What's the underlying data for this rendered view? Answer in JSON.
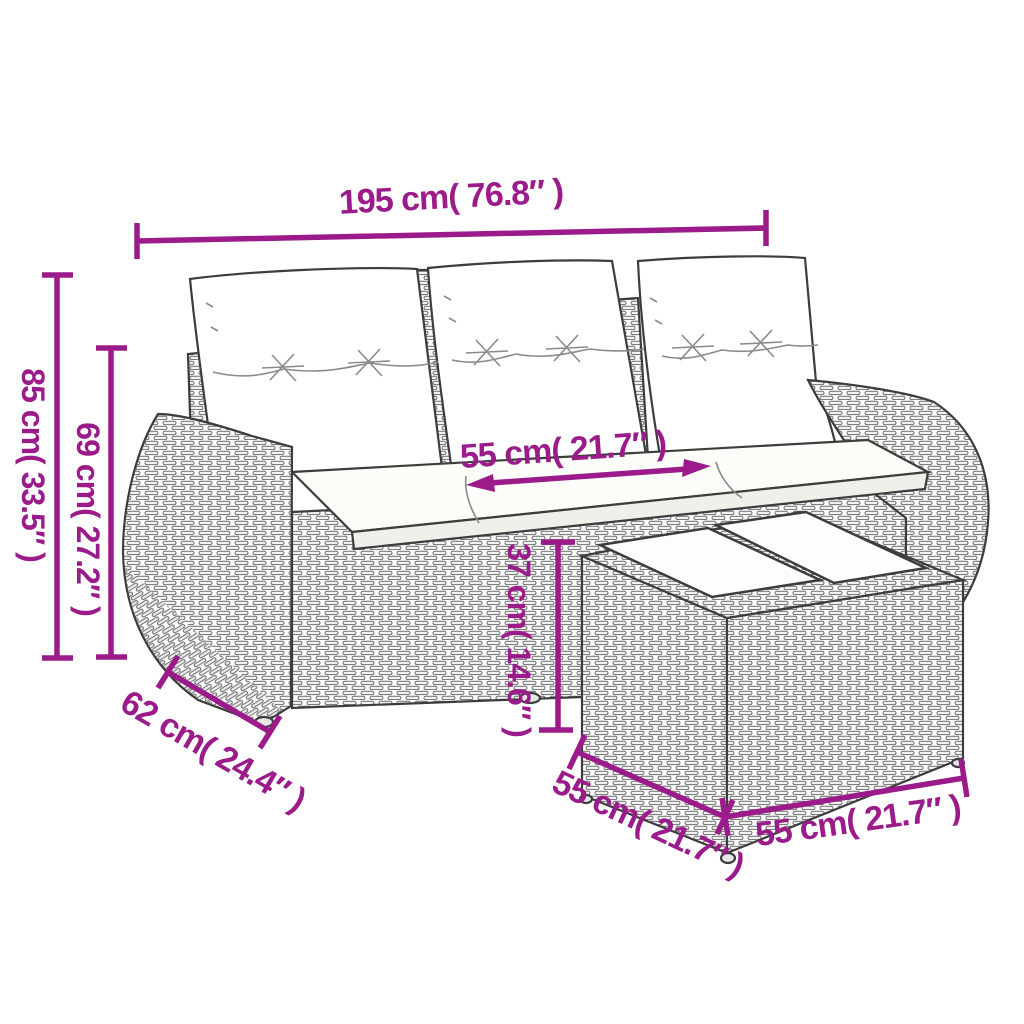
{
  "diagram": {
    "type": "product-dimension-diagram",
    "subject": "poly-rattan garden sofa with cushions and footstool table",
    "furniture": {
      "back_cushion_count": 3,
      "seat_cushion_count": 3,
      "footstool_top_panel_count": 2
    },
    "dimensions": {
      "overall_width": {
        "label": "195 cm( 76.8″ )",
        "cm": 195,
        "inch": 76.8
      },
      "overall_height": {
        "label": "85 cm( 33.5″ )",
        "cm": 85,
        "inch": 33.5
      },
      "back_height": {
        "label": "69 cm( 27.2″ )",
        "cm": 69,
        "inch": 27.2
      },
      "seat_width": {
        "label": "55 cm( 21.7″ )",
        "cm": 55,
        "inch": 21.7
      },
      "stool_height": {
        "label": "37 cm( 14.6″ )",
        "cm": 37,
        "inch": 14.6
      },
      "sofa_depth": {
        "label": "62 cm( 24.4″ )",
        "cm": 62,
        "inch": 24.4
      },
      "stool_depth": {
        "label": "55 cm( 21.7″ )",
        "cm": 55,
        "inch": 21.7
      },
      "stool_width": {
        "label": "55 cm( 21.7″ )",
        "cm": 55,
        "inch": 21.7
      }
    },
    "colors": {
      "dimension_accent": "#9B1B8A",
      "line_art": "#3d3d3d",
      "background": "#ffffff"
    }
  }
}
